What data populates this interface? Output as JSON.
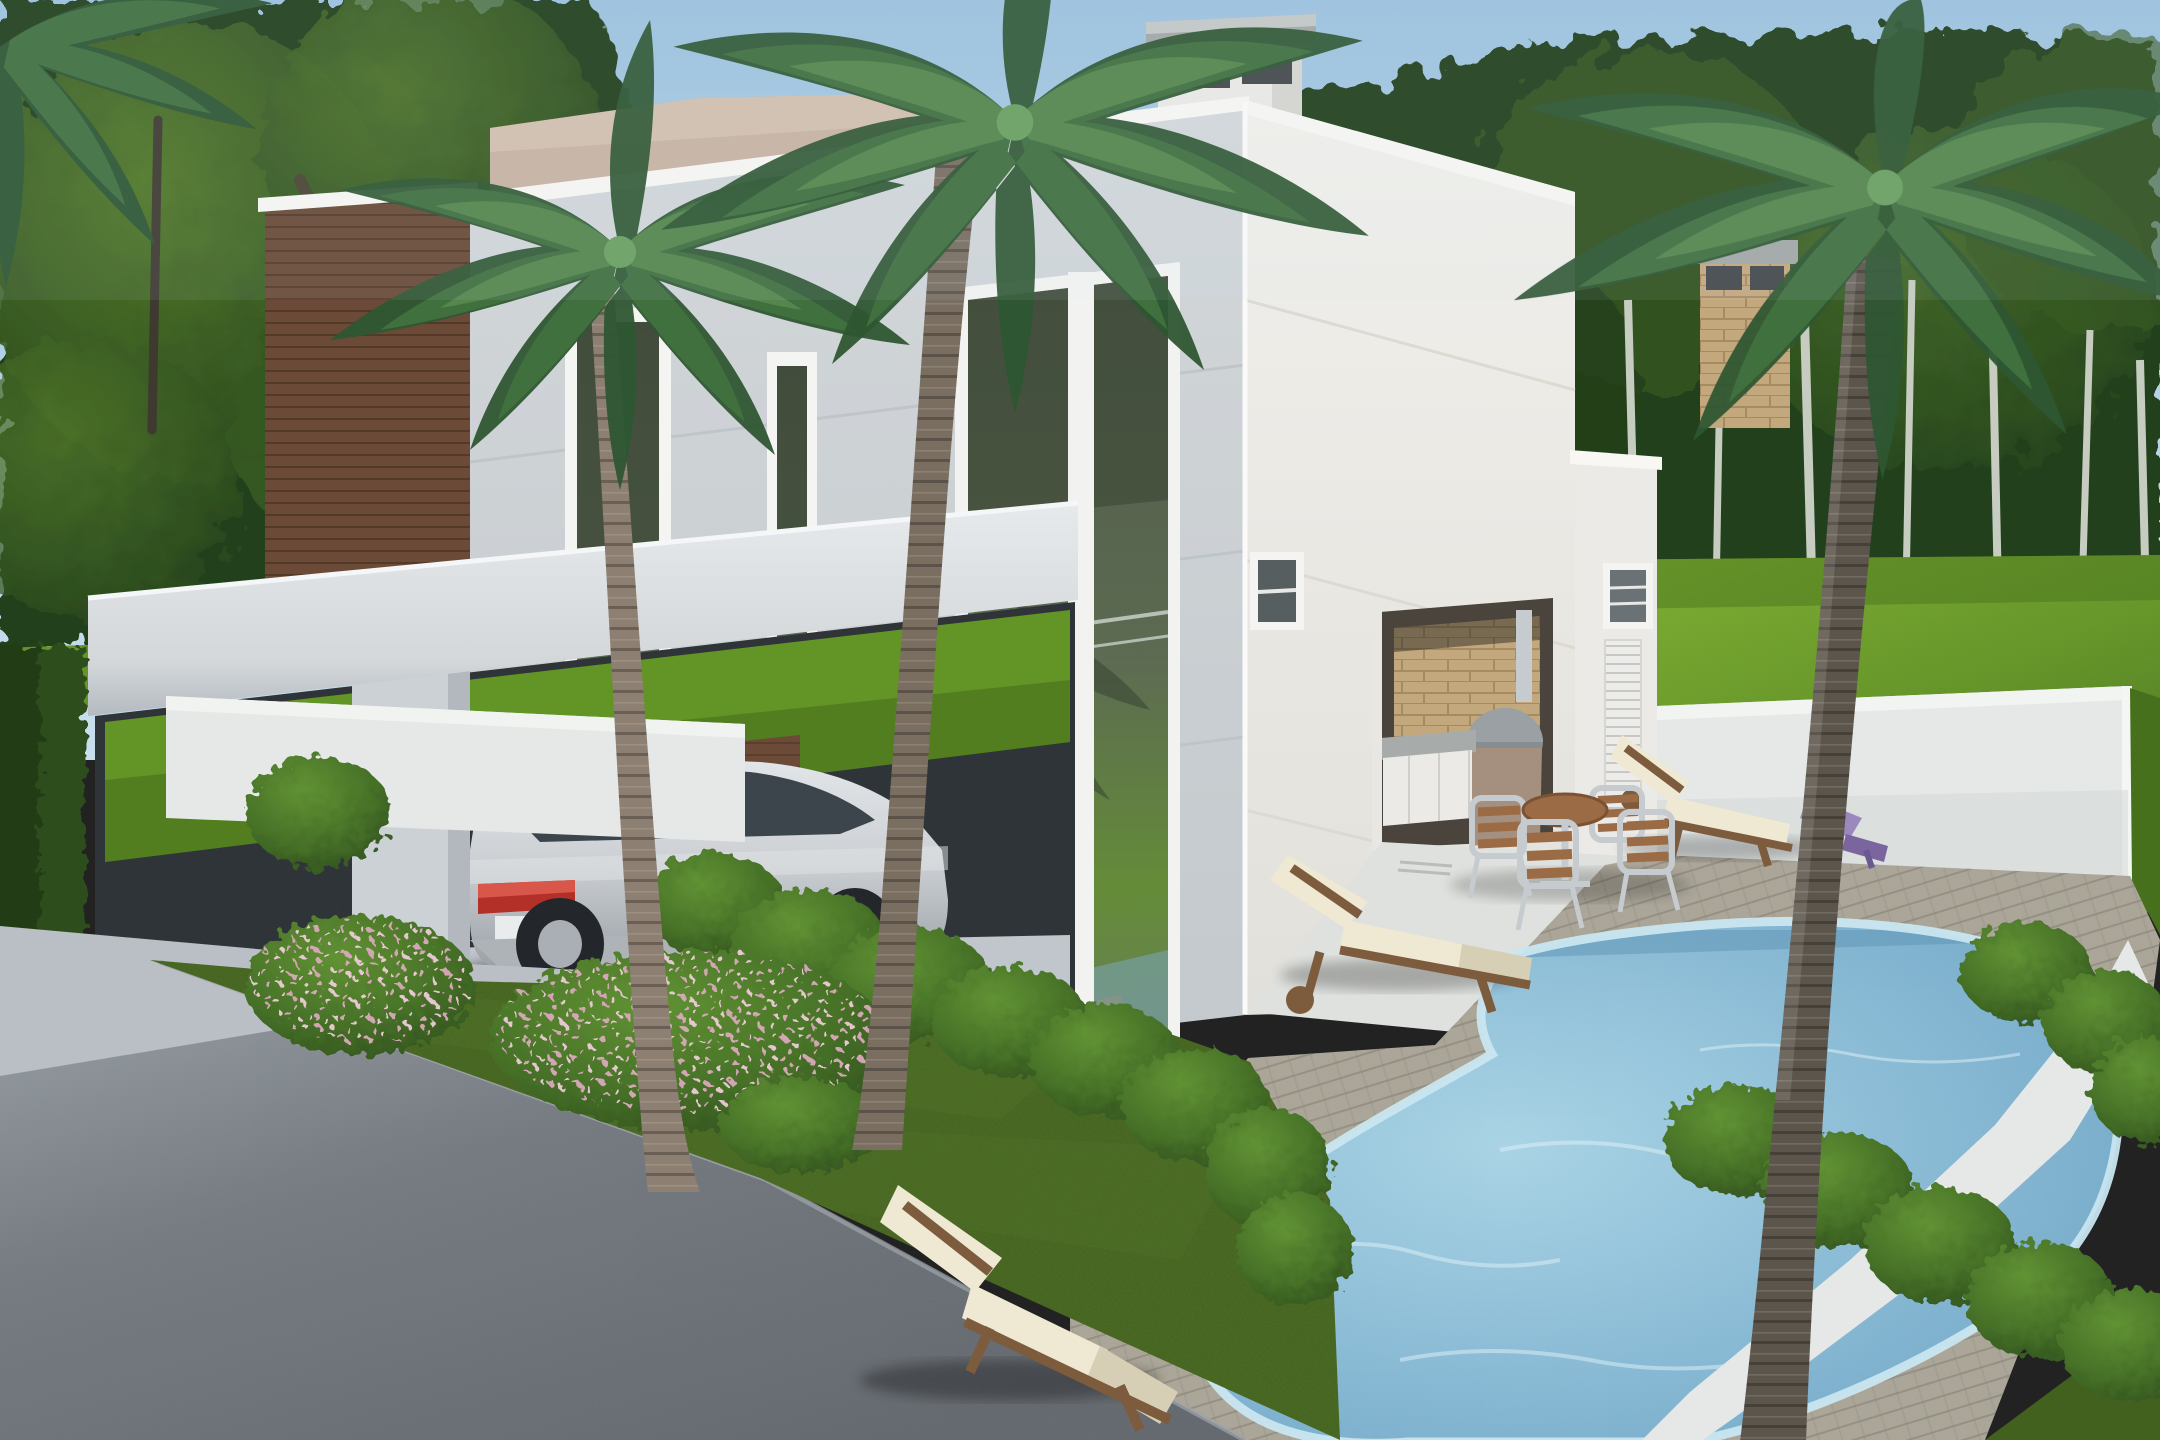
{
  "meta": {
    "title": "3D exterior rendering: modern white two-story house with palm trees, carport and pool",
    "render_type": "photorealistic architectural visualization",
    "canvas": {
      "width": 2160,
      "height": 1440
    },
    "no_visible_text": true
  },
  "palette": {
    "sky_top": "#9dc2de",
    "sky_horizon": "#c9dfee",
    "trees_dark": "#24401b",
    "trees_mid": "#3a5c24",
    "trees_light": "#587f2c",
    "birch": "#c6ccc0",
    "branch": "#4a4434",
    "lawn_bright": "#82b231",
    "lawn_mid": "#639426",
    "lawn_dark": "#47701d",
    "grass_front": "#42611e",
    "grass_front_light": "#53762a",
    "road": "#72787e",
    "road_light": "#9aa1a7",
    "driveway": "#b9bfc5",
    "facade_front": "#d3d7da",
    "facade_front_dark": "#c2c8cc",
    "facade_side": "#f1f0ec",
    "facade_side_dark": "#e2e0da",
    "parapet": "#f8f7f4",
    "groove": "#bcc3c7",
    "wood": "#6b4a37",
    "wood_dark": "#4f3526",
    "beige_block": "#c8b3a2",
    "chimney": "#ebeae6",
    "chimney_shade": "#d6d4cf",
    "concrete_cap": "#a3a7a6",
    "vent_dark": "#44484b",
    "brick_light": "#c3a87e",
    "brick_dark": "#a68a60",
    "glass_dark": "#4e5848",
    "glass_mid": "#5d6b52",
    "reflect_lawn": "#648c38",
    "reflect_pale": "#aebcb4",
    "pool_light": "#a9d4e6",
    "pool_mid": "#7fb3d0",
    "pool_deep": "#639bbd",
    "pool_rim": "#c9e6f0",
    "deck": "#aaa597",
    "deck_line": "#8d887a",
    "wall_white": "#e5e8e6",
    "wall_shade": "#d1d6d5",
    "patio": "#dfe1de",
    "cushion": "#efe8d2",
    "cushion_shade": "#d7cfb5",
    "frame_wood": "#7d5c3e",
    "alu": "#c6cbcf",
    "slat": "#9a6b44",
    "purple": "#9b88bc",
    "purple_dark": "#7a659e",
    "bush_dark": "#2e4d1c",
    "bush_mid": "#477228",
    "bush_light": "#619233",
    "flower_pink": "#d9a8ba",
    "flower_pink_light": "#ecccd6",
    "trunk_left": "#8d7f71",
    "trunk_front": "#7a6e61",
    "trunk_right": "#5c554b",
    "frond_dark": "#2e5632",
    "frond_mid": "#41703f",
    "frond_light": "#55864d",
    "frond_pale": "#6ba061",
    "car_body": "#ccd0d4",
    "car_body_dark": "#9ba1a7",
    "car_glass": "#3c444c",
    "taillight": "#b33028",
    "taillight_bright": "#d8574a",
    "oven": "#878d90",
    "oven_base": "#a5907f",
    "cabinet": "#ebeae6",
    "counter": "#a7acab",
    "louver": "#ececea"
  },
  "scene": {
    "sky": {
      "condition": "clear, light haze at horizon"
    },
    "background": {
      "tree_belt": "dense green deciduous trees across full width",
      "birch_trunks_count": 7,
      "back_lawn": "bright sunlit lawn strip behind house and right side"
    },
    "house": {
      "style": "modern flat-roof white volumes",
      "volumes": [
        {
          "name": "wood-clad-tower",
          "material": "brown horizontal wood siding",
          "approx_box": [
            265,
            195,
            470,
            660
          ]
        },
        {
          "name": "beige-rear-block",
          "material": "beige stucco",
          "approx_box": [
            490,
            90,
            978,
            230
          ]
        },
        {
          "name": "main-cube-front-facade",
          "material": "white stucco with horizontal grooves",
          "approx_box": [
            470,
            100,
            1245,
            1060
          ]
        },
        {
          "name": "main-cube-side-facade",
          "material": "bright white stucco",
          "approx_box": [
            1245,
            100,
            1575,
            1012
          ]
        },
        {
          "name": "pool-house-wing",
          "material": "white stucco, louvered door + small shelf window",
          "approx_box": [
            1575,
            450,
            1657,
            1000
          ]
        }
      ],
      "chimneys": [
        {
          "name": "white-chimney",
          "cap": "gray concrete slab with dark vent slots",
          "approx_box": [
            1146,
            20,
            1316,
            142
          ]
        },
        {
          "name": "brick-chimney",
          "material": "cream brick, gray cap",
          "approx_box": [
            1692,
            240,
            1798,
            425
          ]
        }
      ],
      "windows": [
        {
          "name": "tall-window-wide",
          "approx_box": [
            573,
            318,
            662,
            1085
          ]
        },
        {
          "name": "tall-window-narrow",
          "approx_box": [
            775,
            362,
            808,
            1115
          ]
        },
        {
          "name": "corner-glass-window",
          "approx_box": [
            965,
            295,
            1168,
            1132
          ],
          "note": "reflects lawn, railing, palm and pool"
        },
        {
          "name": "small-side-window",
          "approx_box": [
            1252,
            556,
            1298,
            625
          ]
        },
        {
          "name": "shelf-window",
          "approx_box": [
            1605,
            567,
            1648,
            625
          ]
        }
      ],
      "outdoor_kitchen": {
        "name": "barbecue-niche",
        "features": [
          "brick back wall",
          "concrete counter",
          "white cabinets",
          "gray dome oven",
          "steel flue"
        ],
        "approx_box": [
          1374,
          600,
          1553,
          848
        ]
      }
    },
    "carport": {
      "roof_slab": "white cantilevered slab",
      "column": "white pier",
      "car": {
        "type": "silver SUV coupe",
        "view": "rear three-quarter",
        "taillights": "red",
        "count": 1
      }
    },
    "pool_area": {
      "pool": {
        "shape": "kidney / freeform",
        "water": "light blue with ripples",
        "deck": "weathered wood planks"
      },
      "perimeter_wall": "low white wall backing the deck",
      "furniture": {
        "wood_loungers_with_cream_cushions": 3,
        "purple_kids_lounger": 1,
        "round_table": 1,
        "aluminum_wood_slat_chairs": 4
      }
    },
    "landscaping": {
      "palms": [
        {
          "name": "palm-left",
          "trunk": "slim, behind carport lawn strip"
        },
        {
          "name": "palm-front",
          "trunk": "tall, crosses facade and carport"
        },
        {
          "name": "palm-right",
          "trunk": "thick dark ringed trunk by pool"
        },
        {
          "name": "palm-corner",
          "note": "crown entering top-left corner"
        }
      ],
      "pink_flower_bushes": 3,
      "hedge_bush_rows": 2,
      "round_bushes": 2,
      "front_lawn": "shaded olive green strip",
      "left_boundary": "low white wall and dark hedge"
    },
    "street": {
      "road": "gray asphalt, bottom-left diagonal",
      "driveway": "light concrete apron to carport"
    }
  }
}
